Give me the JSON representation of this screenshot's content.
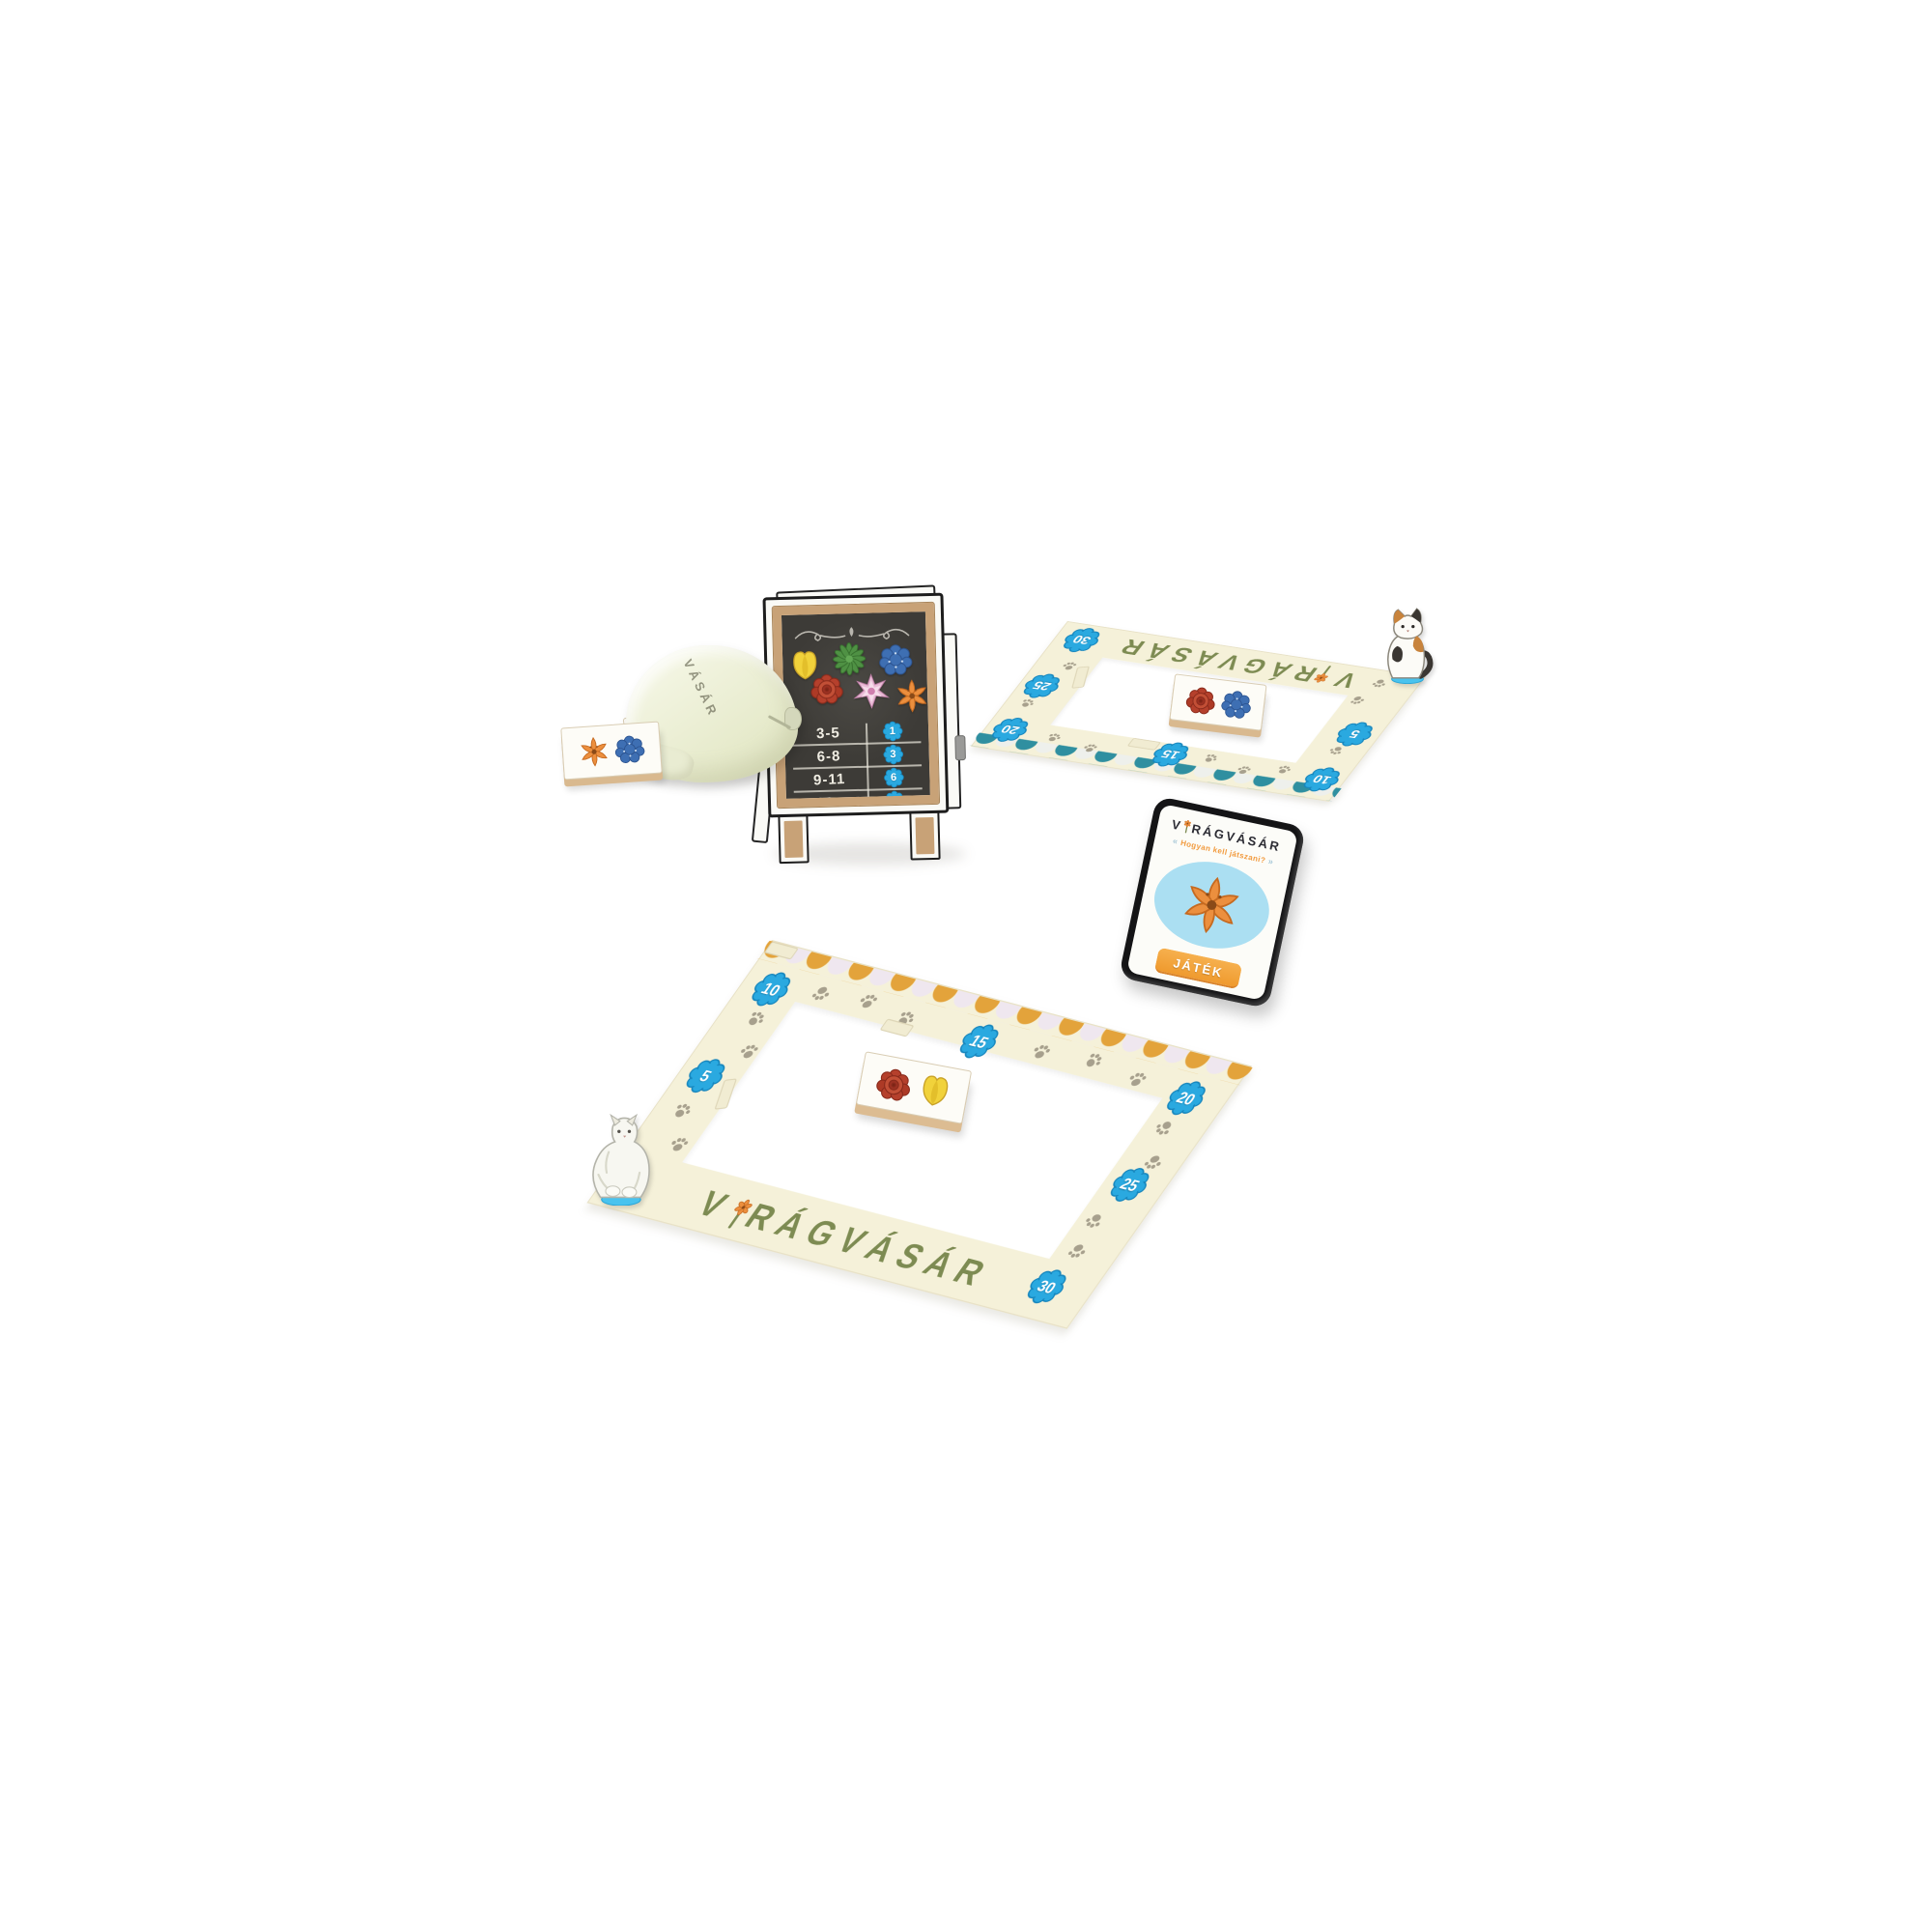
{
  "colors": {
    "badge_blue": "#2aa9e0",
    "awning_teal": "#2f8fa0",
    "awning_gold": "#e3a33b",
    "board_cream": "#f5f1d9",
    "title_green": "#7d8b52",
    "button_orange": "#f09d3a",
    "subtitle_orange": "#f29b3f",
    "chalkboard_dark": "#413f3b",
    "wood_tan": "#c8a277",
    "paw_gray": "#a7a08d",
    "cloud_blue": "#49c3ee"
  },
  "easel": {
    "rows": [
      {
        "count": "3-5",
        "points": "1"
      },
      {
        "count": "6-8",
        "points": "3"
      },
      {
        "count": "9-11",
        "points": "6"
      },
      {
        "count": "12+",
        "points": "10"
      }
    ],
    "flowers": [
      "yellow-tulip",
      "green-chrysanthemum",
      "blue-hydrangea",
      "red-rose",
      "pink-dahlia",
      "orange-lily"
    ]
  },
  "bag": {
    "text": "VÁSÁR"
  },
  "boards": {
    "top": {
      "title_prefix": "V",
      "title_suffix": "RÁGVÁSÁR",
      "badges": [
        "5",
        "10",
        "15",
        "20",
        "25",
        "30"
      ],
      "cat": "calico-cat"
    },
    "bottom": {
      "title_prefix": "V",
      "title_suffix": "RÁGVÁSÁR",
      "badges": [
        "5",
        "10",
        "15",
        "20",
        "25",
        "30"
      ],
      "cat": "white-cat"
    }
  },
  "phone": {
    "title_prefix": "V",
    "title_suffix": "RÁGVÁSÁR",
    "subtitle": "Hogyan kell játszani?",
    "button": "JÁTÉK"
  },
  "tiles": {
    "near_bag": [
      "orange-lily",
      "blue-hydrangea"
    ],
    "behind_bag": [
      "green-chrysanthemum",
      "green-chrysanthemum"
    ],
    "top_board": [
      "red-rose",
      "blue-hydrangea"
    ],
    "bottom_board": [
      "red-rose",
      "yellow-tulip"
    ]
  }
}
